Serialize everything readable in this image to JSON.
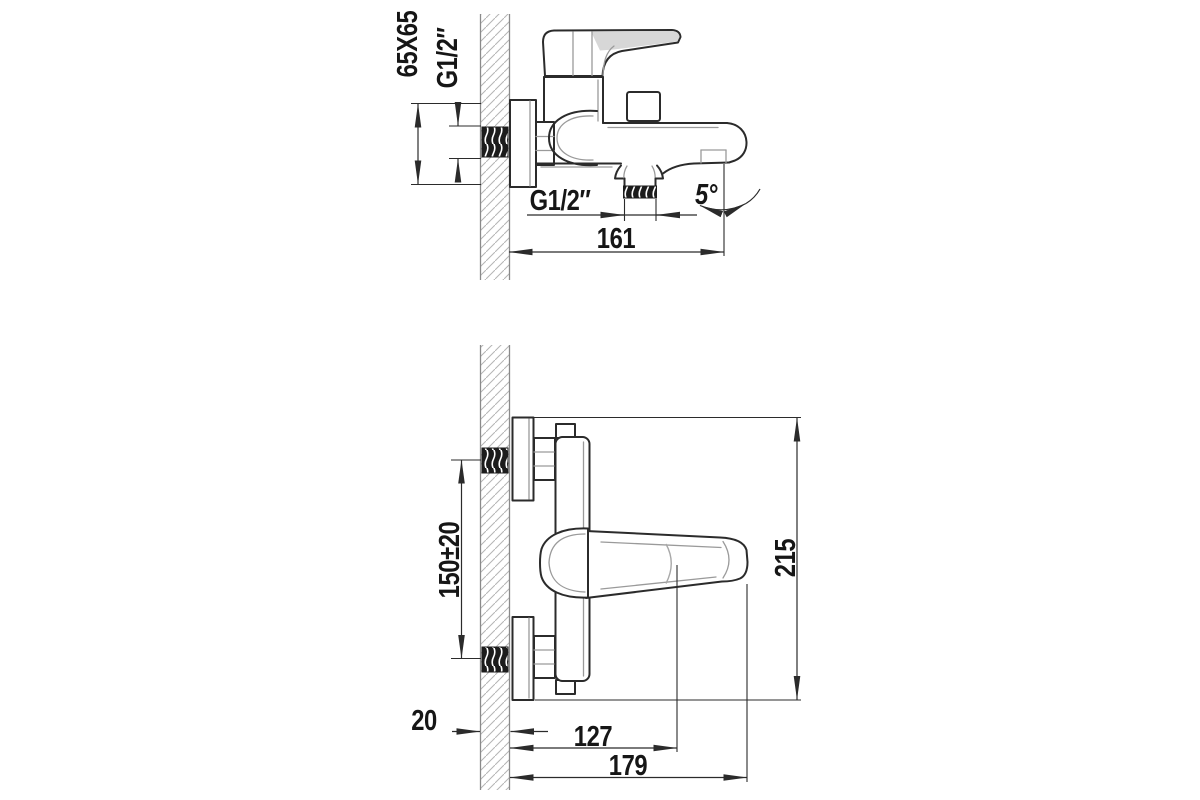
{
  "drawing": {
    "title": "bath-mixer-installation-drawing",
    "colors": {
      "line": "#2b2b2b",
      "hatch": "#b5b5b5",
      "thread_fill": "#1c1c1c"
    },
    "top_view": {
      "flange_size": "65X65",
      "inlet_thread": "G1/2″",
      "shower_thread": "G1/2″",
      "spout_angle": "5°",
      "spout_reach": "161"
    },
    "bottom_view": {
      "centers_distance": "150±20",
      "overall_height": "215",
      "wall_thickness": "20",
      "spout_center_depth": "127",
      "overall_depth": "179"
    }
  }
}
